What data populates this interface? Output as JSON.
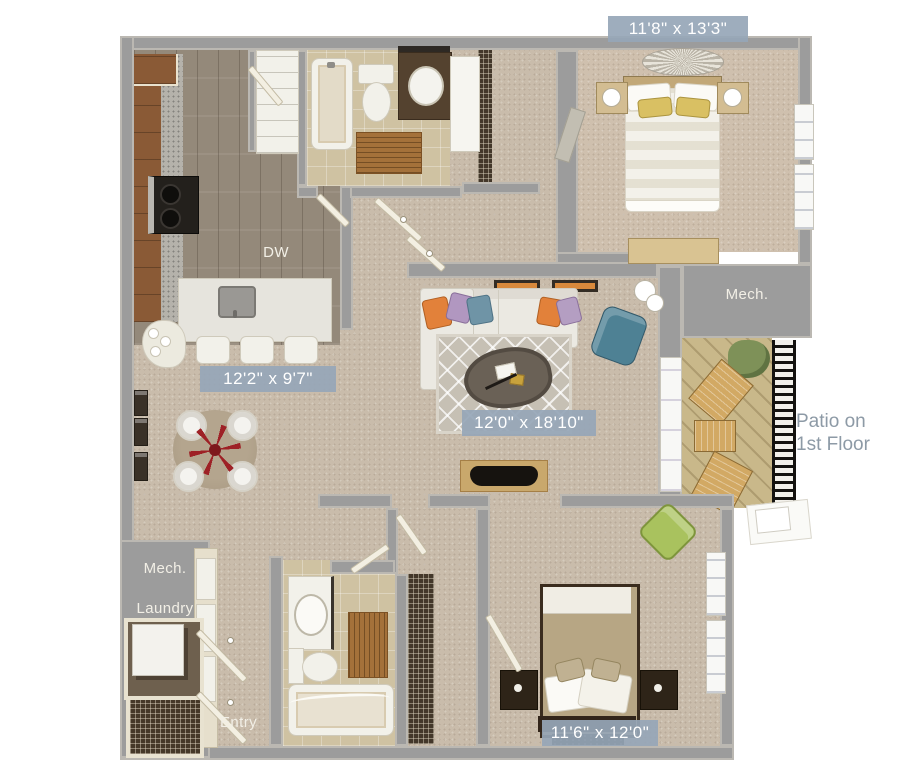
{
  "badges": {
    "bedroom1": "11'8\" x 13'3\"",
    "kitchen": "12'2\" x 9'7\"",
    "living": "12'0\" x 18'10\"",
    "bedroom2": "11'6\" x 12'0\""
  },
  "labels": {
    "dw": "DW",
    "mech_upper": "Mech.",
    "mech_lower": "Mech.",
    "laundry": "Laundry",
    "entry": "Entry",
    "patio_line1": "Patio on",
    "patio_line2": "1st Floor"
  },
  "colors": {
    "wall": "#9c9c9c",
    "badge_bg": "#96a6b7",
    "badge_text": "#ffffff",
    "patio_text": "#8d9aa6",
    "carpet": "#c9bcab",
    "wood_floor": "#94897a",
    "bath_tile": "#cfc2a2",
    "deck": "#c9b88a",
    "accent_red": "#9e2126",
    "accent_orange": "#e2813a",
    "accent_teal": "#4e8194",
    "accent_green": "#a9c25e"
  }
}
